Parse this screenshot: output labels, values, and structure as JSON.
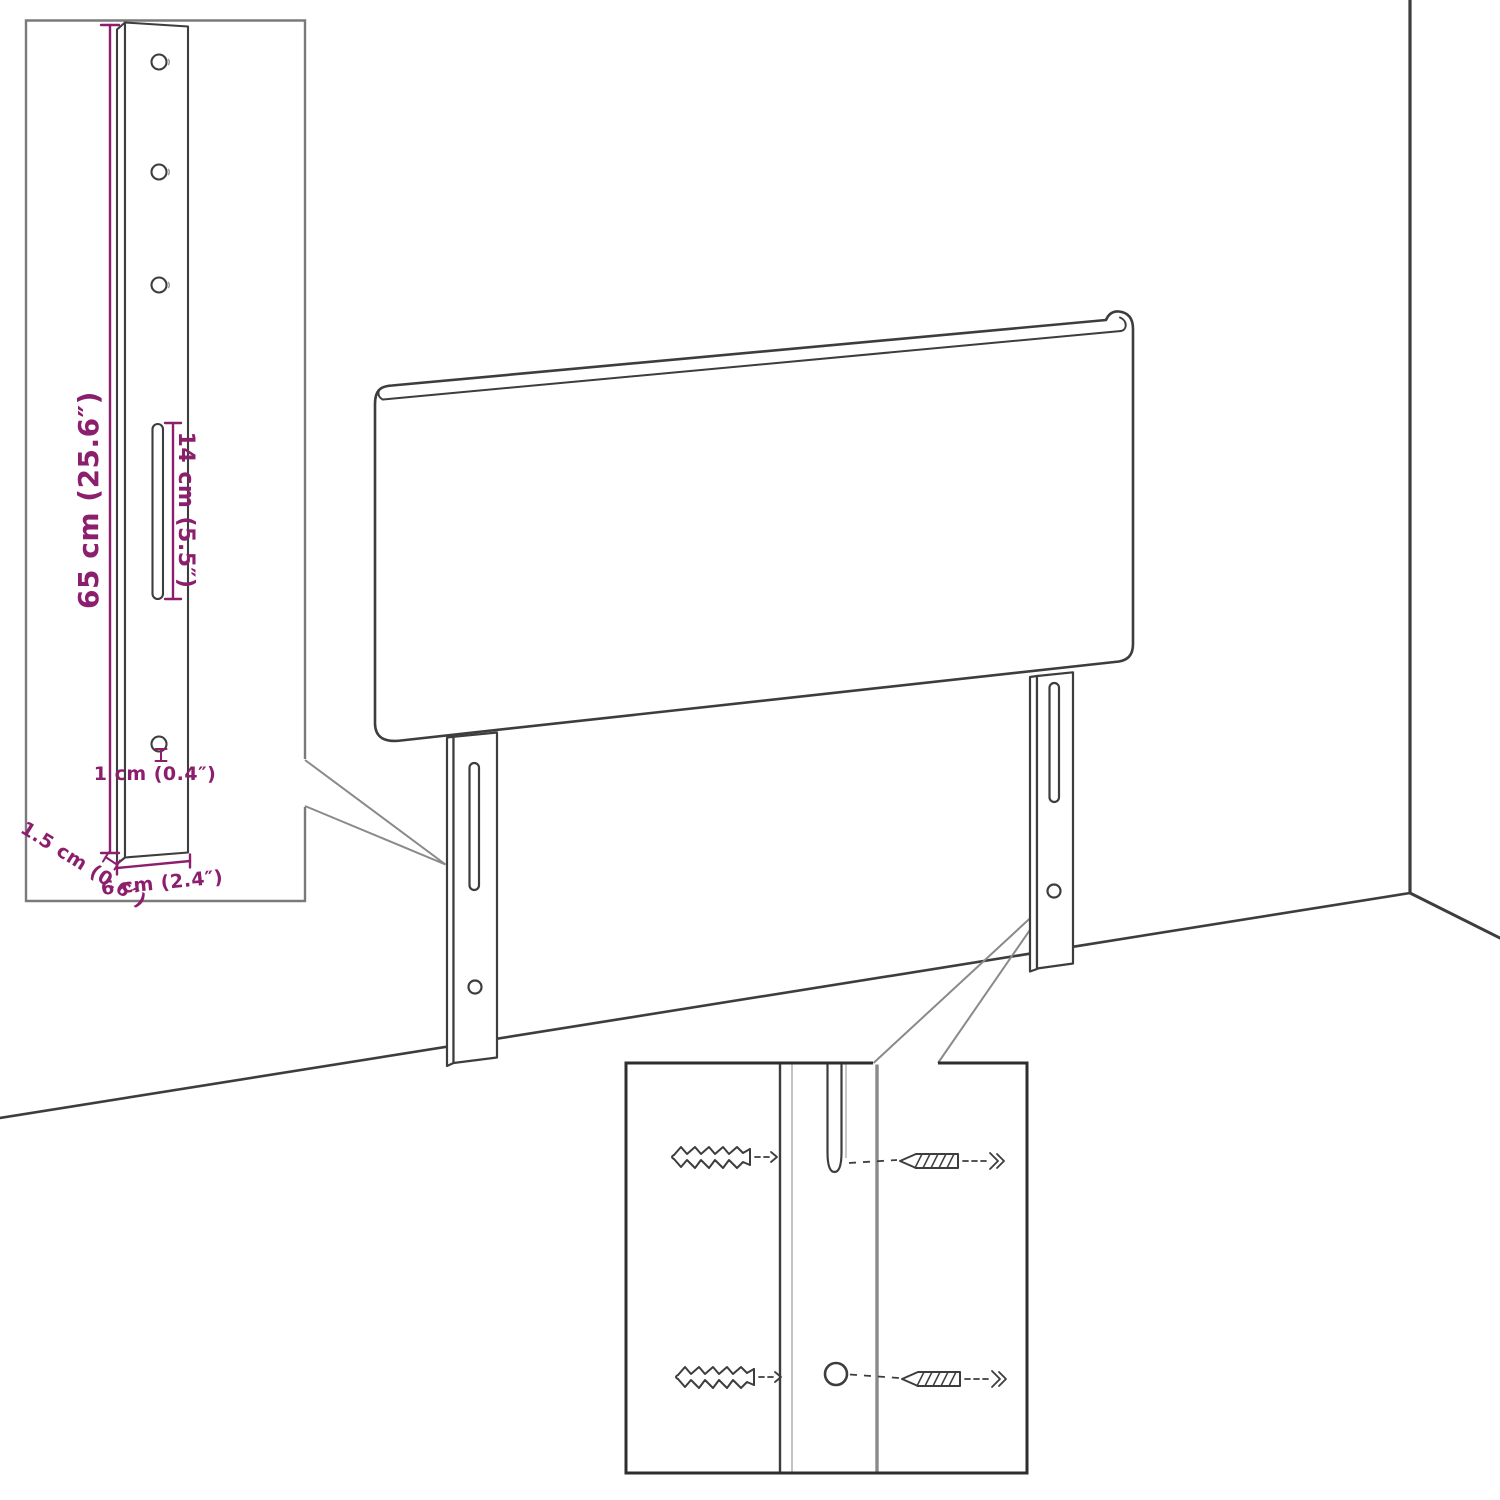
{
  "diagram": {
    "subject": "headboard-wall-mounting-dimension-diagram",
    "labels": {
      "leg_height": "65 cm (25.6″)",
      "slot_length": "14 cm (5.5″)",
      "hole_diameter": "1 cm (0.4″)",
      "leg_thickness": "1.5 cm (0.6″)",
      "leg_width": "6 cm (2.4″)"
    },
    "colors": {
      "dimension_accent": "#8b1f6e",
      "outline": "#3d3d3d",
      "inset_border_light": "#7a7a7a",
      "inset_border_dark": "#2e2e2e",
      "leader": "#8a8a8a",
      "shadow_gray": "#9a9a9a"
    }
  }
}
